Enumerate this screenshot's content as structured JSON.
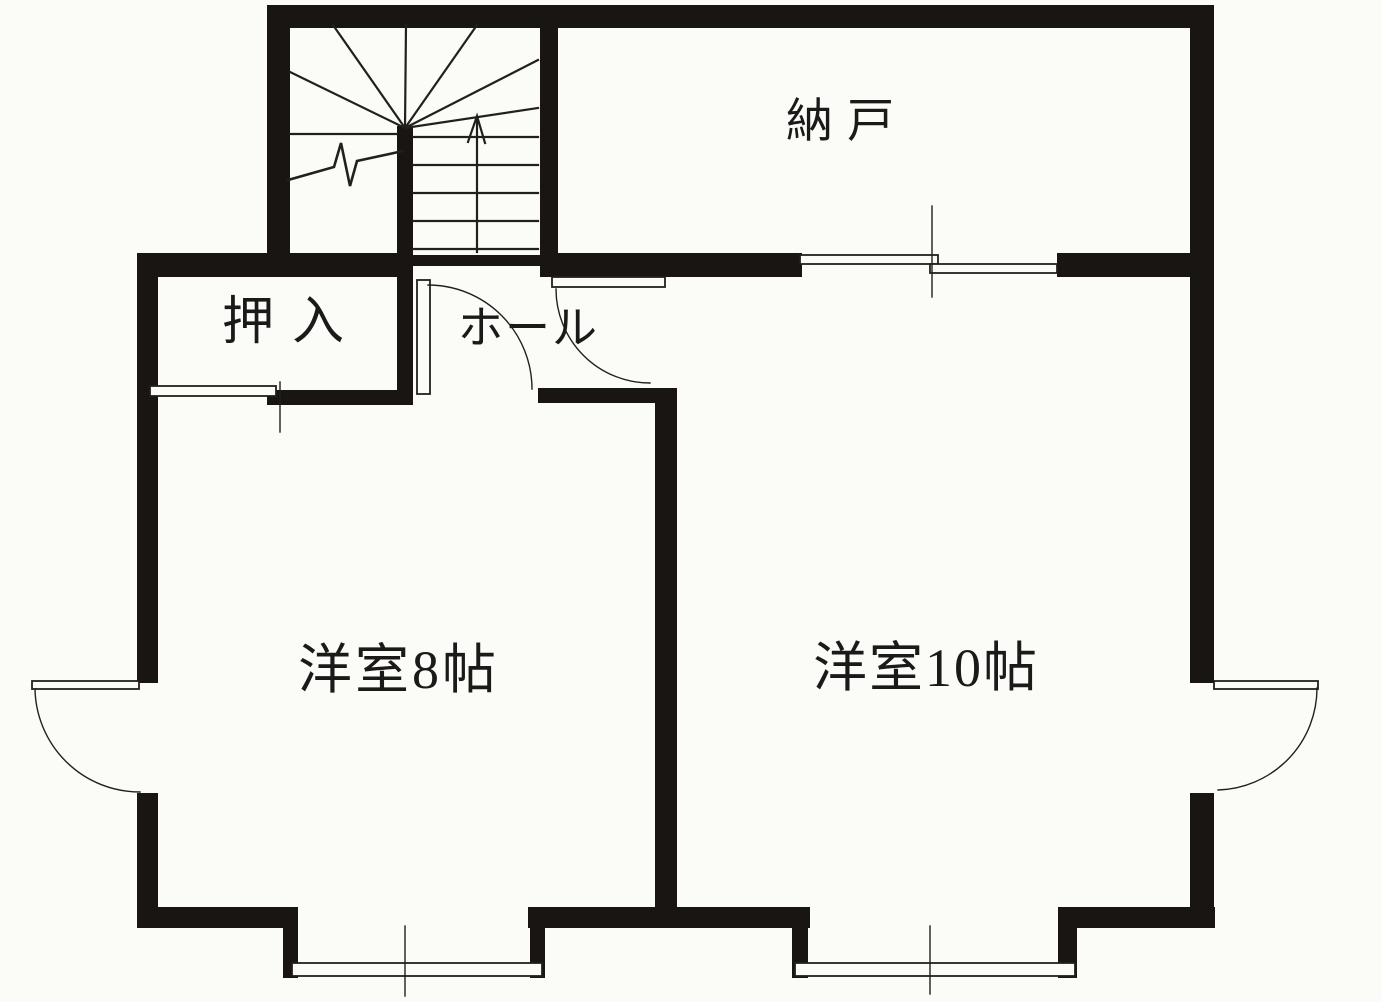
{
  "document": {
    "type": "japanese-floor-plan",
    "language": "ja"
  },
  "colors": {
    "paper": "#fbfbf8",
    "wall": "#181512",
    "line": "#22201d"
  },
  "rooms": {
    "storage": {
      "label": "納戸"
    },
    "closet": {
      "label": "押入"
    },
    "hall": {
      "label": "ホール"
    },
    "western_room_8": {
      "label": "洋室8帖"
    },
    "western_room_10": {
      "label": "洋室10帖"
    }
  },
  "symbols": {
    "staircase": "winder-staircase-with-up-arrow",
    "stair_break_mark": "zigzag-break-line",
    "swing_door": "quarter-circle-door-arc",
    "sliding_door": "offset-double-line-sliding-door",
    "bay_window": "protruding-sill-bay-window",
    "casement_window": "outswing-quarter-arc-window"
  }
}
